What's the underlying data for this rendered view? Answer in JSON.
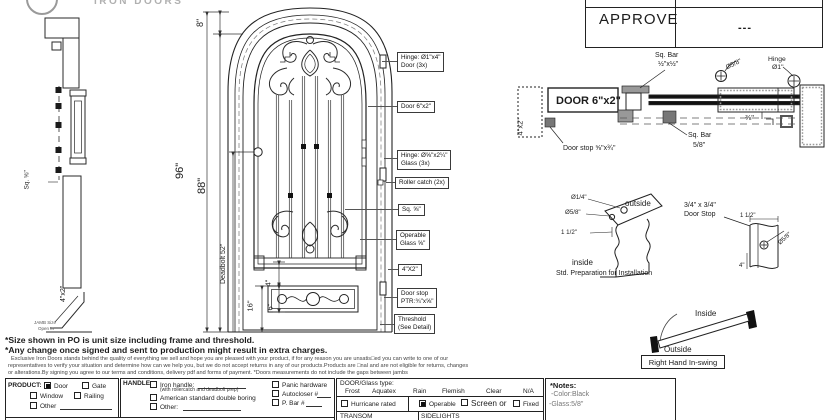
{
  "logo": {
    "wordmark": "IRON DOORS"
  },
  "approve": {
    "label": "APPROVE",
    "value": "---"
  },
  "section_view": {
    "sq_label": "Sq. ⅝\"",
    "frame_label": "4\"x2\"",
    "jamb_note1": "JAMB Size",
    "jamb_note2": "Open In"
  },
  "elevation": {
    "dim_8": "8\"",
    "dim_96": "96\"",
    "dim_88": "88\"",
    "dim_deadbolt": "Deadbolt 52\"",
    "dim_16": "16\"",
    "dim_4": "4\"",
    "dim_6": "6\"",
    "callouts": [
      {
        "line1": "Hinge: Ø1\"x4\"",
        "line2": "Door (3x)"
      },
      {
        "line1": "Door 6\"x2\""
      },
      {
        "line1": "Hinge: Ø⅝\"x2¼\"",
        "line2": "Glass (3x)"
      },
      {
        "line1": "Roller catch  (2x)"
      },
      {
        "line1": "Sq. ⅝\""
      },
      {
        "line1": "Operable",
        "line2": "Glass ⅝\""
      },
      {
        "line1": "4\"X2\""
      },
      {
        "line1": "Door stop",
        "line2": "PTR:¾\"x⅝\""
      },
      {
        "line1": "Threshold",
        "line2": "(See Detail)"
      }
    ]
  },
  "plan": {
    "jamb_left": "4\"x2\"",
    "door_label": "DOOR 6\"x2\"",
    "sqbar_top1": "Sq. Bar",
    "sqbar_top2": "½\"x½\"",
    "dia58": "Ø5/8\"",
    "hinge1": "Hinge",
    "hinge2": "Ø1\"",
    "dim38": "⅜\"",
    "sqbar_bot1": "Sq. Bar",
    "sqbar_bot2": "5/8\"",
    "doorstop": "Door stop ⅝\"x¾\""
  },
  "prep_detail": {
    "dia14": "Ø1/4\"",
    "dia58": "Ø5/8\"",
    "dim112": "1 1/2\"",
    "outside": "outside",
    "inside": "inside",
    "caption": "Std. Preparation for Installation"
  },
  "stop_detail": {
    "label1": "3/4\" x 3/4\"",
    "label2": "Door Stop",
    "dim112": "1 1/2\"",
    "dia58": "Ø5/8\"",
    "dim4": "4\""
  },
  "swing": {
    "inside": "Inside",
    "outside": "Outside",
    "label": "Right Hand In-swing"
  },
  "notes": {
    "size_note": "*Size shown in PO is unit size including frame and threshold.",
    "change_note": "*Any change once signed and sent to production might result in extra charges.",
    "fine_print": [
      "Exclusive Iron Doors stands behind the quality of everything we sell and hope you are pleased with your product, if for any reason you are unsatis□ed you can write to one of our",
      "representatives to verify your situation and determine how can we help you, but we do not accept returns in any of our products.Products are □nal and are not eligible for returns, changes",
      "or alterations.By signing you agree to our terms and conditions, delivery pdf and forms of payment. *Doors measurements do not include the gaps between jambs"
    ]
  },
  "form": {
    "product": {
      "label": "PRODUCT:",
      "options": [
        {
          "label": "Door",
          "checked": true
        },
        {
          "label": "Gate",
          "checked": false
        },
        {
          "label": "Window",
          "checked": false
        },
        {
          "label": "Railing",
          "checked": false
        },
        {
          "label": "Other",
          "checked": false
        }
      ]
    },
    "handle": {
      "label": "HANDLE:",
      "iron_handle": "Iron handle:",
      "iron_handle_sub": "(with rollercatch and deadbolt prep)",
      "american": "American standard double boring",
      "other": "Other:",
      "panic": "Panic hardware",
      "autocloser": "Autocloser #",
      "pbar": "P. Bar #"
    },
    "glass": {
      "label": "DOOR/Glass type:",
      "types": [
        "Frost",
        "Aquatex",
        "Rain",
        "Flemish",
        "Clear",
        "N/A"
      ],
      "hurricane": "Hurricane rated",
      "hurricane_checked": false,
      "operable": "Operable",
      "operable_checked": true,
      "screen": "Screen or",
      "screen_checked": false,
      "fixed": "Fixed",
      "fixed_checked": false,
      "transom": "TRANSOM",
      "sidelights": "SIDELIGHTS"
    },
    "notes_box": {
      "title": "*Notes:",
      "color": "-Color:Black",
      "glass": "-Glass:5/8\""
    }
  }
}
